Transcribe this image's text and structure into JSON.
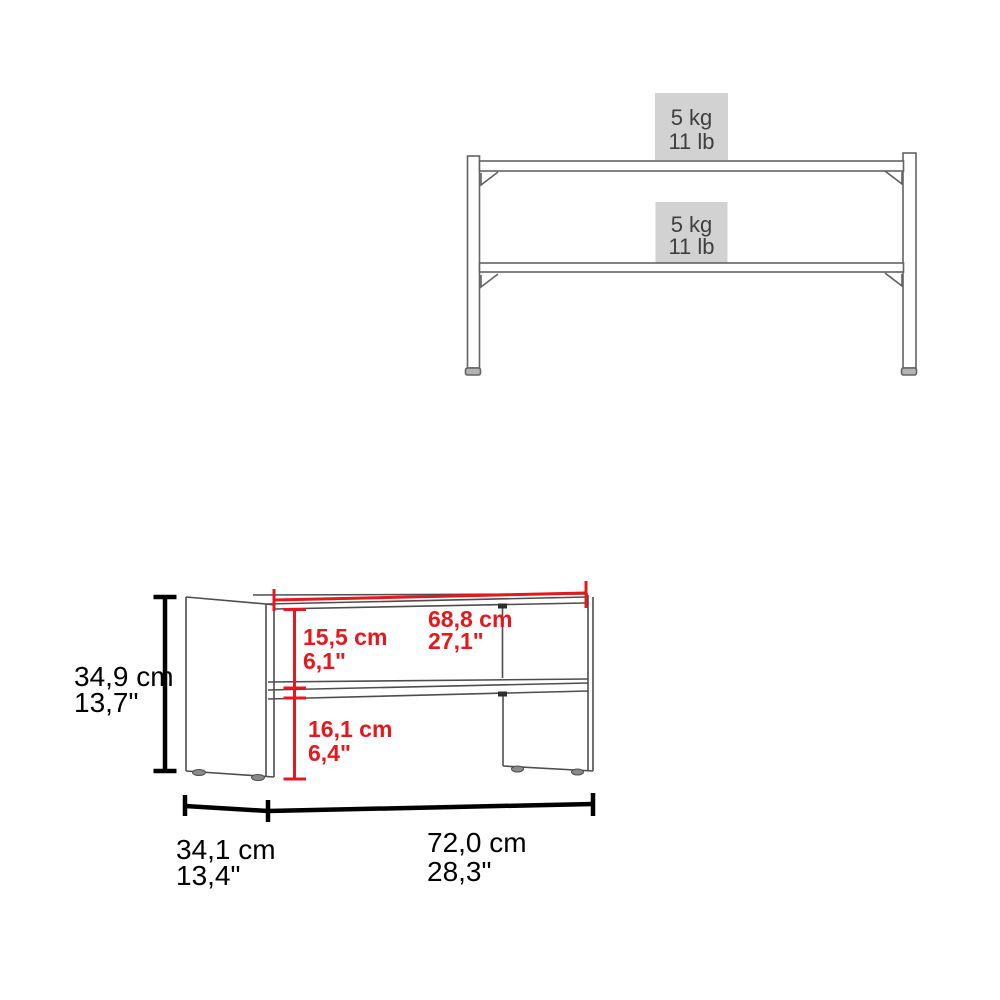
{
  "product_type": "two-shelf coffee table dimension diagram",
  "colors": {
    "background": "#ffffff",
    "dimension_red": "#e4181d",
    "dimension_black": "#000000",
    "furniture_line_gray": "#4d4d4d",
    "frame_line_gray": "#636363",
    "load_box_bg": "#d2d2d2",
    "load_text_gray": "#3f3f3f"
  },
  "load_capacity_view": {
    "top_shelf_label": {
      "metric": "5 kg",
      "imperial": "11 lb"
    },
    "bottom_shelf_label": {
      "metric": "5 kg",
      "imperial": "11 lb"
    }
  },
  "dimensions_view": {
    "overall_height": {
      "metric": "34,9 cm",
      "imperial": "13,7\""
    },
    "inner_width": {
      "metric": "68,8 cm",
      "imperial": "27,1\""
    },
    "upper_opening_height": {
      "metric": "15,5 cm",
      "imperial": "6,1\""
    },
    "lower_opening_height": {
      "metric": "16,1 cm",
      "imperial": "6,4\""
    },
    "overall_depth": {
      "metric": "34,1 cm",
      "imperial": "13,4\""
    },
    "overall_width": {
      "metric": "72,0 cm",
      "imperial": "28,3\""
    }
  }
}
